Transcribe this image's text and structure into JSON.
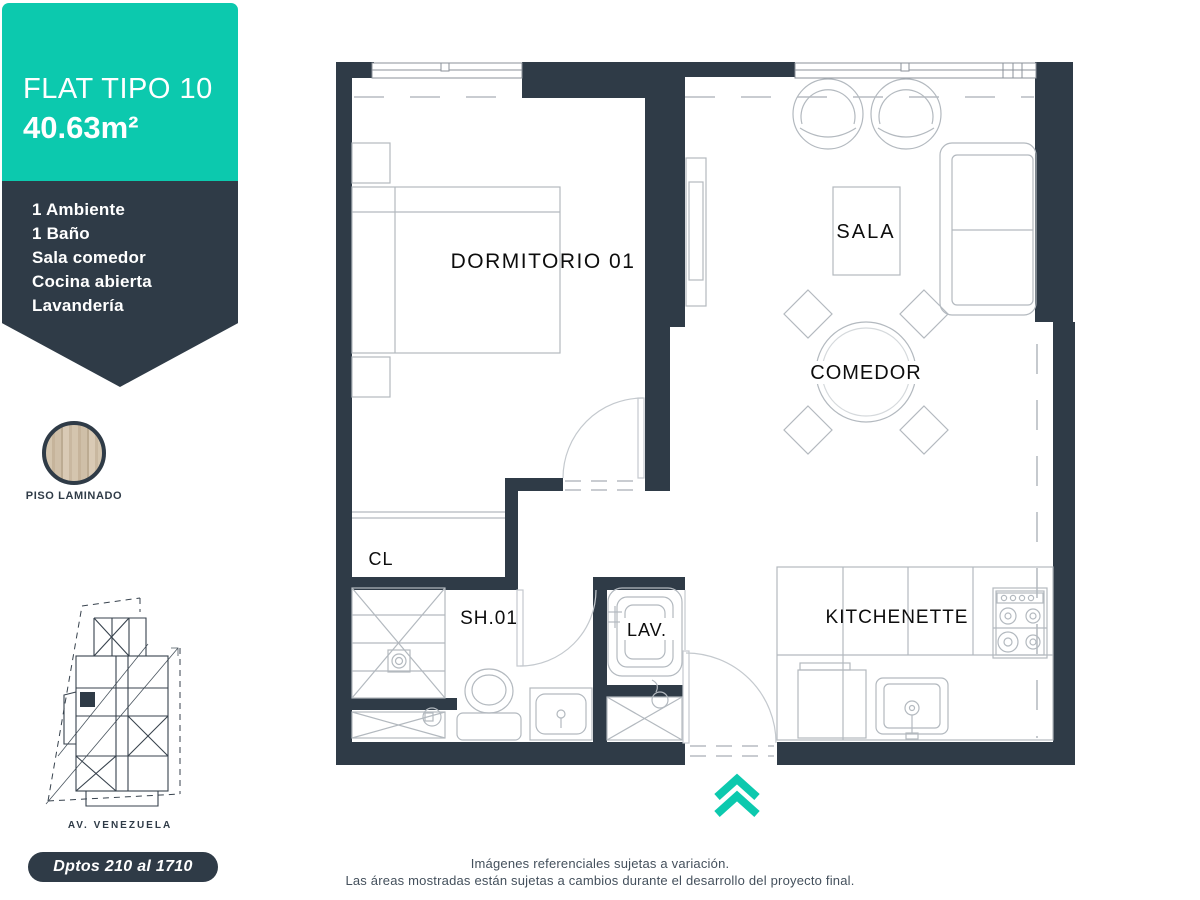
{
  "colors": {
    "accent_teal": "#0cc9ae",
    "dark_slate": "#2f3b47",
    "furniture_line": "#b3b9bf",
    "label_text": "#0d0d0d"
  },
  "sidebar": {
    "title": "FLAT TIPO 10",
    "area": "40.63m²",
    "features": [
      "1 Ambiente",
      "1 Baño",
      "Sala comedor",
      "Cocina abierta",
      "Lavandería"
    ],
    "swatch_label": "PISO LAMINADO",
    "badge": "Dptos 210 al 1710"
  },
  "siteplan": {
    "street": "AV. VENEZUELA"
  },
  "plan": {
    "rooms": {
      "bedroom": "DORMITORIO 01",
      "sala": "SALA",
      "dining": "COMEDOR",
      "closet": "CL",
      "bath": "SH.01",
      "laundry": "LAV.",
      "kitchen": "KITCHENETTE"
    }
  },
  "footer": {
    "line1": "Imágenes referenciales sujetas a variación.",
    "line2": "Las áreas mostradas están sujetas a cambios durante el desarrollo del proyecto final."
  }
}
